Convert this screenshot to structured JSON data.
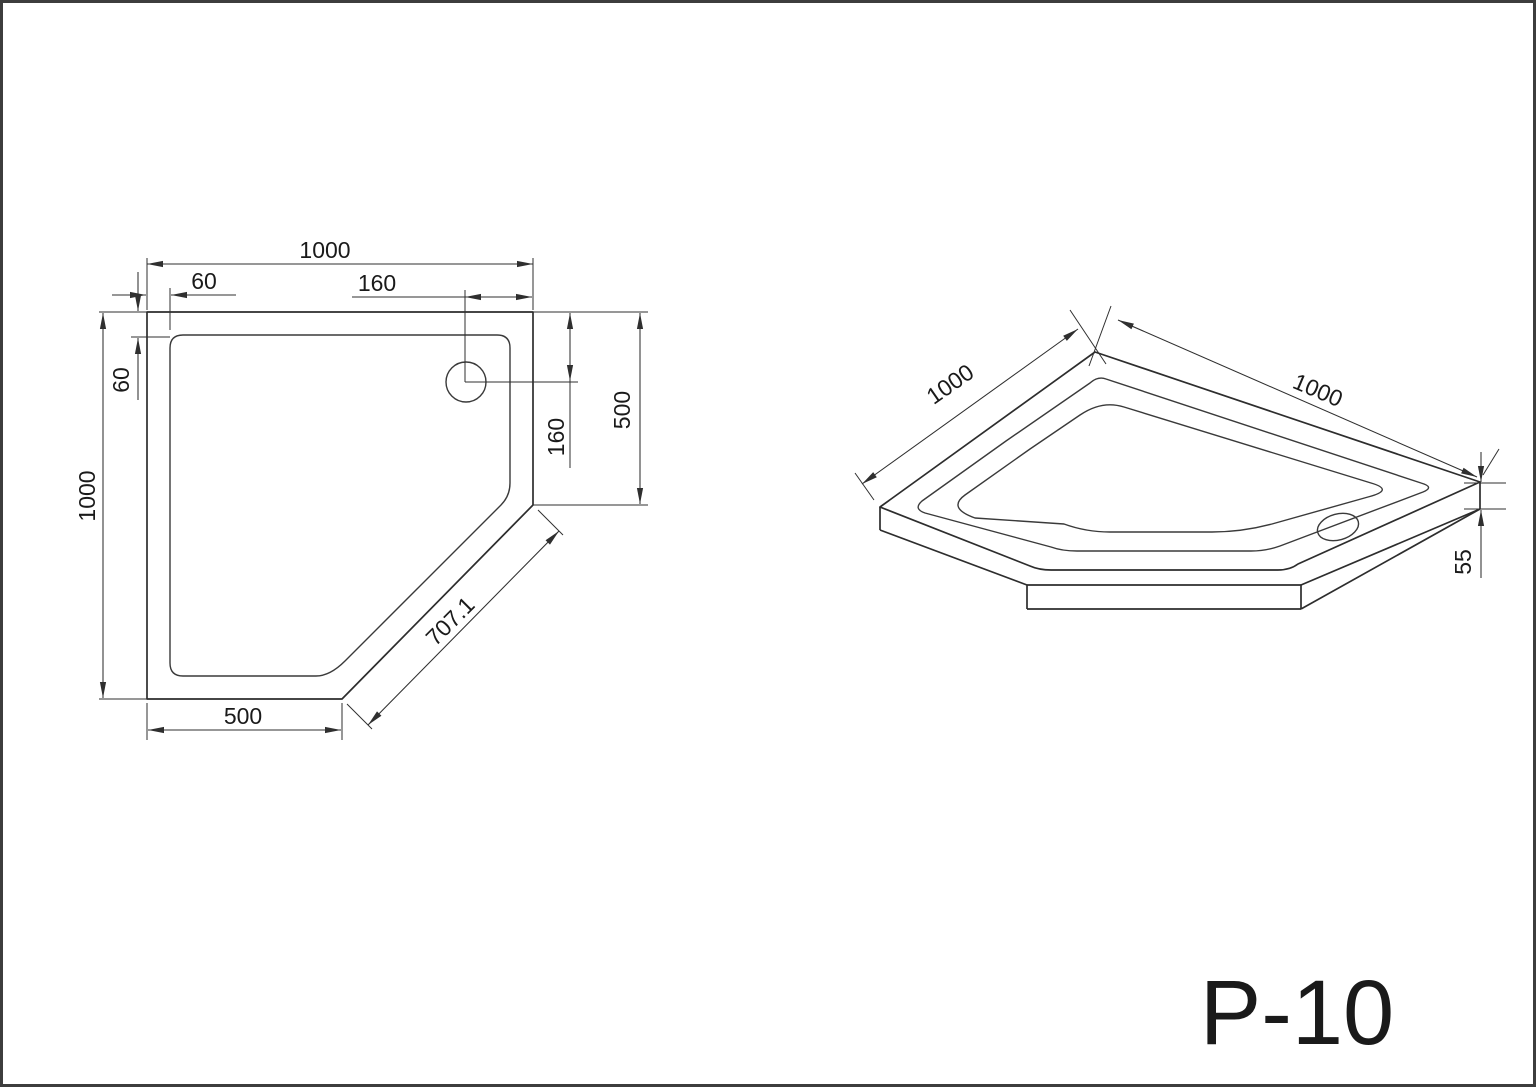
{
  "page": {
    "background": "#ffffff",
    "frame_color": "#3d3d3d",
    "line_color": "#2d2d2d",
    "text_color": "#1a1a1a"
  },
  "title_block": {
    "model_label": "P-10"
  },
  "plan_view": {
    "top_width": "1000",
    "rim_offset_top": "60",
    "drain_offset_right": "160",
    "left_height": "1000",
    "rim_offset_left": "60",
    "drain_offset_down": "160",
    "right_edge": "500",
    "bottom_edge": "500",
    "diagonal_edge": "707.1"
  },
  "iso_view": {
    "left_edge": "1000",
    "right_edge": "1000",
    "thickness": "55"
  }
}
